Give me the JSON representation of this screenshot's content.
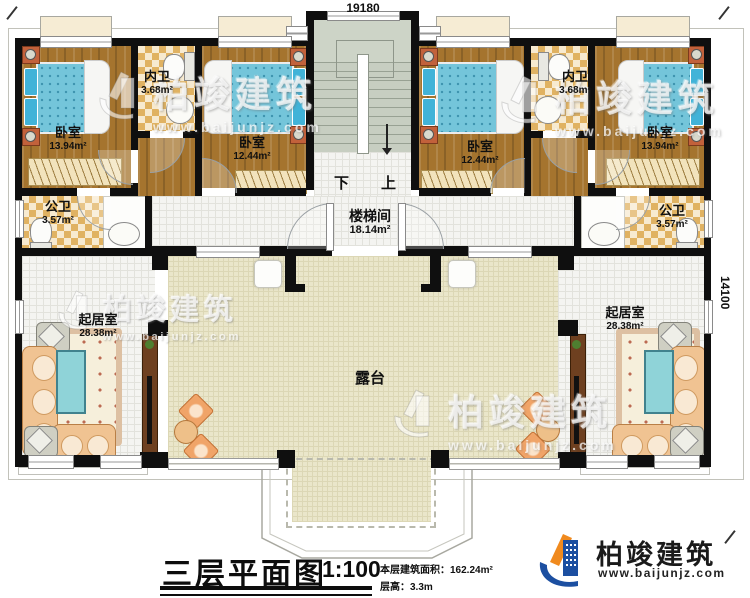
{
  "dimensions": {
    "top": "19180",
    "right": "14100"
  },
  "rooms": {
    "bedroom_far_left": {
      "label": "卧室",
      "area": "13.94m²"
    },
    "bath_inner_left": {
      "label": "内卫",
      "area": "3.68m²"
    },
    "bedroom_mid_left": {
      "label": "卧室",
      "area": "12.44m²"
    },
    "bedroom_mid_right": {
      "label": "卧室",
      "area": "12.44m²"
    },
    "bath_inner_right": {
      "label": "内卫",
      "area": "3.68m²"
    },
    "bedroom_far_right": {
      "label": "卧室",
      "area": "13.94m²"
    },
    "bath_public_left": {
      "label": "公卫",
      "area": "3.57m²"
    },
    "bath_public_right": {
      "label": "公卫",
      "area": "3.57m²"
    },
    "stair_hall": {
      "label": "楼梯间",
      "area": "18.14m²"
    },
    "living_left": {
      "label": "起居室",
      "area": "28.38m²"
    },
    "living_right": {
      "label": "起居室",
      "area": "28.38m²"
    },
    "terrace": {
      "label": "露台"
    }
  },
  "stairs": {
    "down": "下",
    "up": "上"
  },
  "titleblock": {
    "title": "三层平面图",
    "scale": "1:100",
    "area_note": "本层建筑面积：162.24m²",
    "height_note": "层高：3.3m"
  },
  "logo": {
    "name": "柏竣建筑",
    "website": "www.baijunjz.com"
  },
  "watermark": {
    "brand": "柏竣建筑",
    "website": "www.baijunjz.com"
  },
  "colors": {
    "wall": "#0f0f0f",
    "wood": "#a5742e",
    "terrace": "#eae6ca",
    "bed": "#74c5da",
    "logo_blue": "#1c4fa1",
    "logo_orange": "#f08a1e"
  }
}
